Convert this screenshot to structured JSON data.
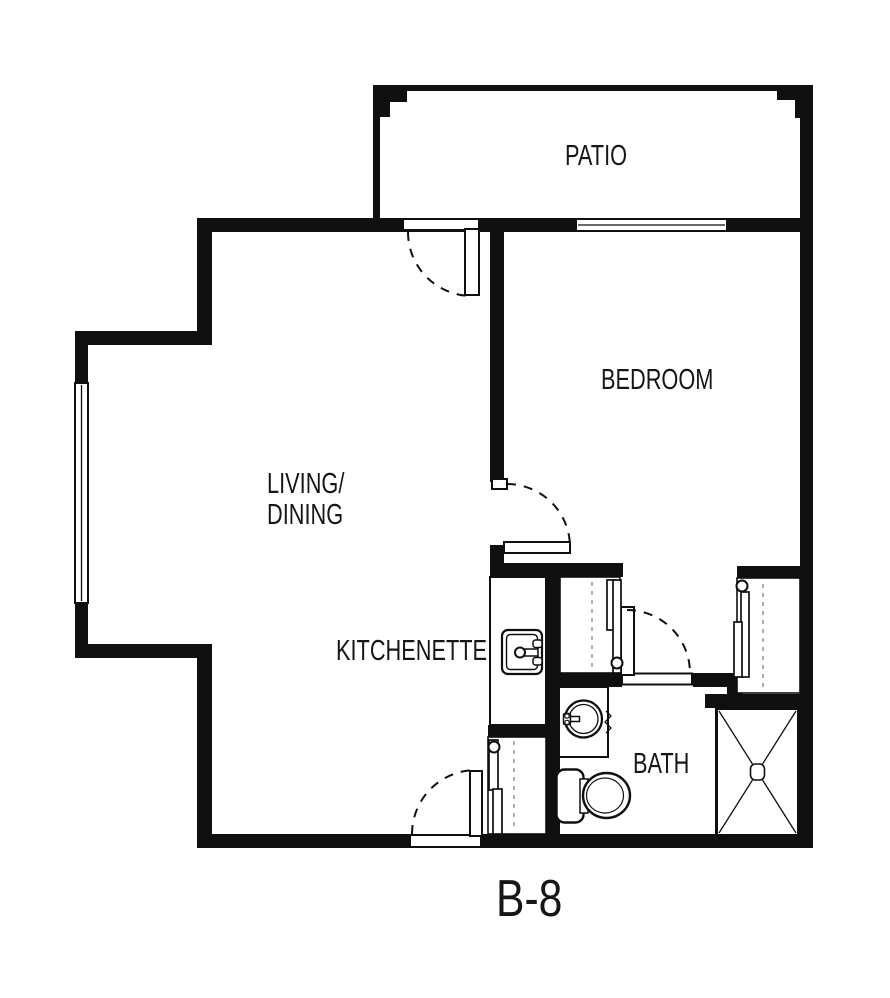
{
  "plan": {
    "title": "B-8",
    "rooms": {
      "patio": "PATIO",
      "bedroom": "BEDROOM",
      "living_line1": "LIVING/",
      "living_line2": "DINING",
      "kitchenette": "KITCHENETTE",
      "bath": "BATH"
    }
  }
}
